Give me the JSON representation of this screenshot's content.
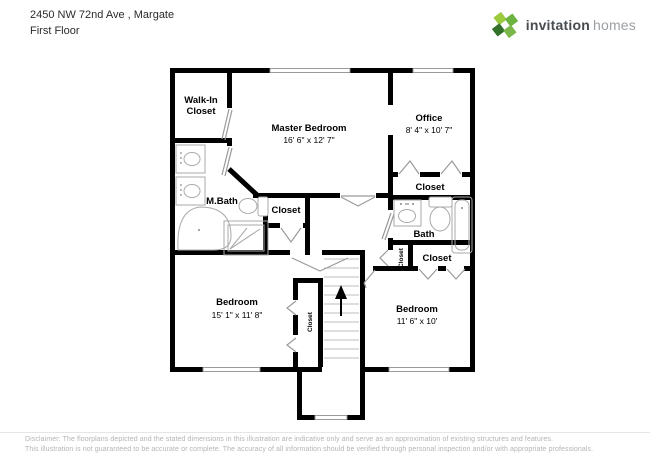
{
  "header": {
    "address": "2450 NW 72nd Ave , Margate",
    "floor_label": "First Floor"
  },
  "logo": {
    "brand_bold": "invitation",
    "brand_light": "homes",
    "icon": "pinwheel-leaf-icon",
    "colors": {
      "green_light": "#9bca3c",
      "green_mid": "#6cb33f",
      "green_dark": "#33702a",
      "green_leaf": "#7ab648",
      "text_dark": "#474c51",
      "text_light": "#9ba0a4"
    }
  },
  "floorplan": {
    "wall_color": "#000000",
    "fixture_color": "#a9a9a9",
    "rooms": {
      "walk_in_closet": {
        "line1": "Walk-In",
        "line2": "Closet"
      },
      "master_bedroom": {
        "name": "Master Bedroom",
        "dims": "16' 6\" x 12' 7\""
      },
      "office": {
        "name": "Office",
        "dims": "8' 4\" x 10' 7\""
      },
      "master_bath": {
        "name": "M.Bath"
      },
      "hall_closet": {
        "name": "Closet"
      },
      "office_closet": {
        "name": "Closet"
      },
      "bath": {
        "name": "Bath"
      },
      "linen_closet": {
        "name": "Closet"
      },
      "bedroom2_closet": {
        "name": "Closet"
      },
      "bedroom2": {
        "name": "Bedroom",
        "dims": "11' 6\" x 10'"
      },
      "bedroom3": {
        "name": "Bedroom",
        "dims": "15' 1\" x 11' 8\""
      },
      "bedroom3_closet": {
        "name": "Closet"
      }
    }
  },
  "footer": {
    "disclaimer_line1": "Disclaimer: The floorplans depicted and the stated dimensions in this illustration are indicative only and serve as an approximation of existing structures and features.",
    "disclaimer_line2": "This illustration is not guaranteed to be accurate or complete. The accuracy of all information should be verified through personal inspection and/or with appropriate professionals."
  }
}
